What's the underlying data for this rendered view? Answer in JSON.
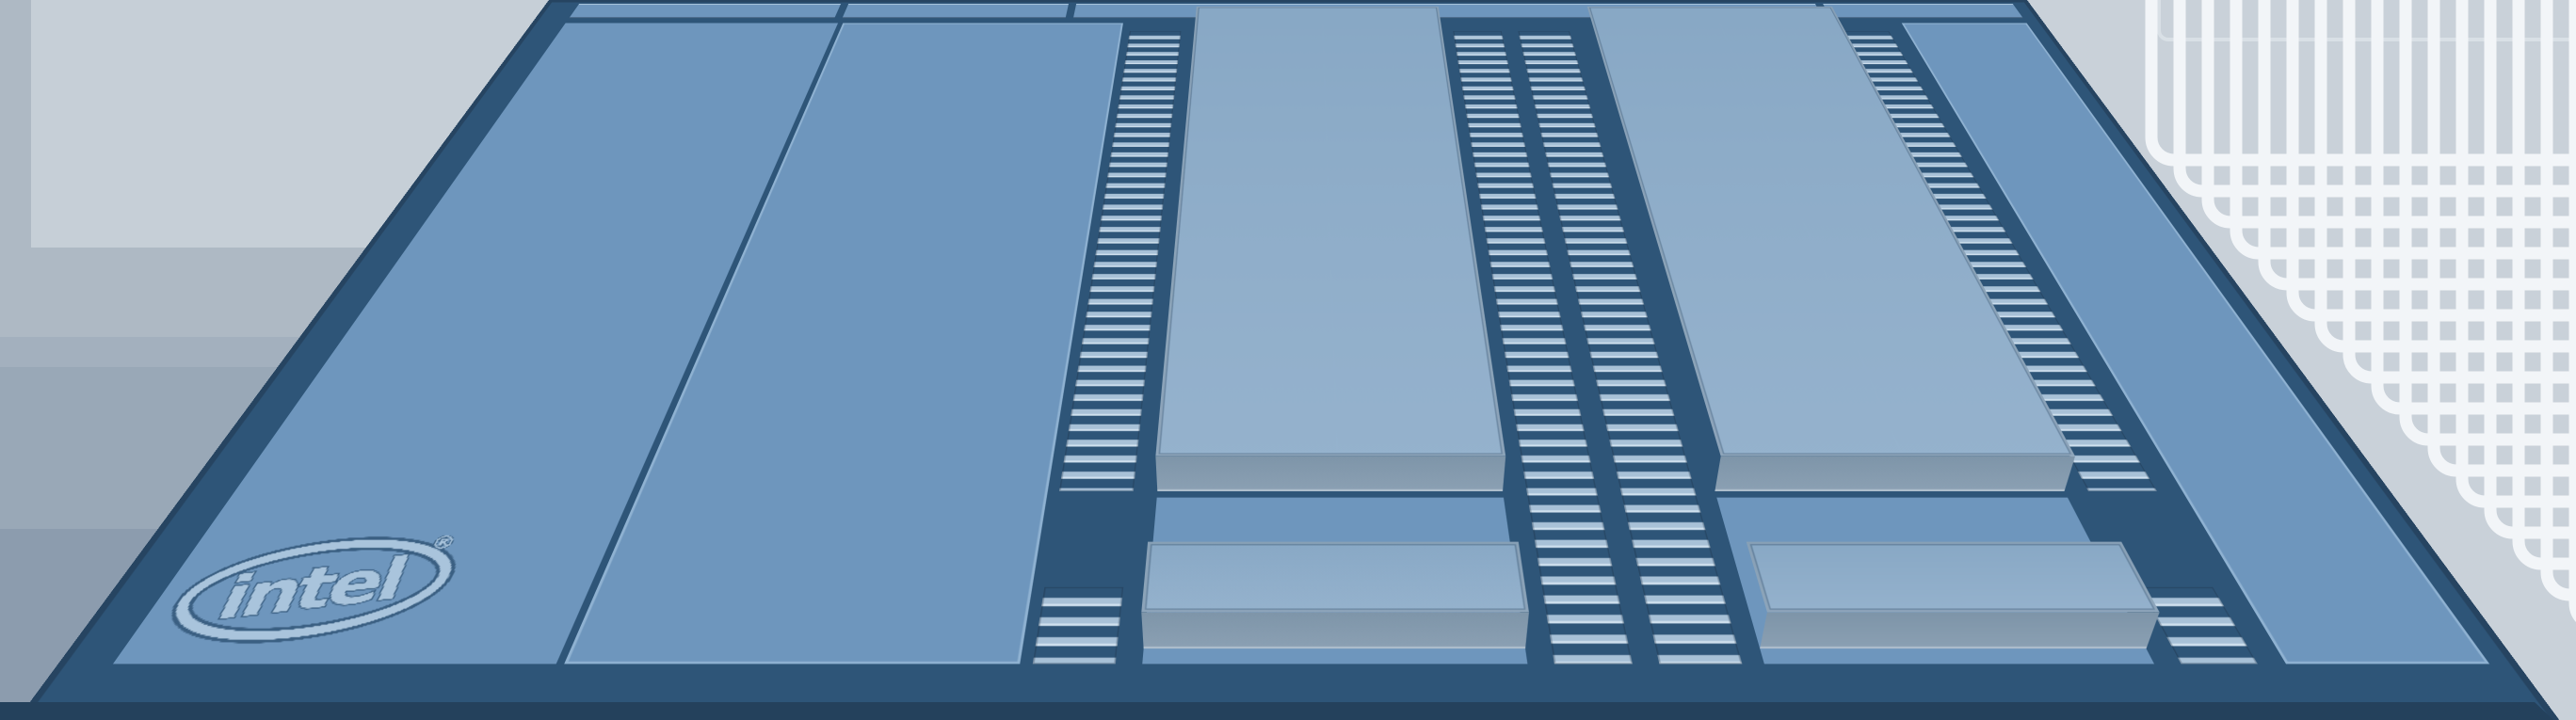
{
  "title": "Intel multi-chiplet processor die 3D illustration",
  "branding": {
    "logo_text": "intel",
    "registered_mark": "®"
  },
  "structure": {
    "chiplet_rows": 2,
    "chiplets_per_row": 2,
    "bridge_columns": 4,
    "top_edge_tiles": 4
  },
  "colors": {
    "background_grey": "#C2CBD4",
    "die_surface": "#6E96BD",
    "die_border": "#2E5578",
    "die_dark_edge": "#24415C",
    "chiplet_top_light": "#88A8C5",
    "chiplet_top_lighter": "#95B2CD",
    "chiplet_front": "#7E95A9",
    "bridge_bar": "#A8C1D7",
    "bridge_bar_highlight": "#CFE0EE",
    "slab_edge_highlight": "#8FB2D2",
    "logo_blue": "#A9C4DC",
    "logo_outline": "#3A5F82",
    "package_lip": "#24415C"
  }
}
